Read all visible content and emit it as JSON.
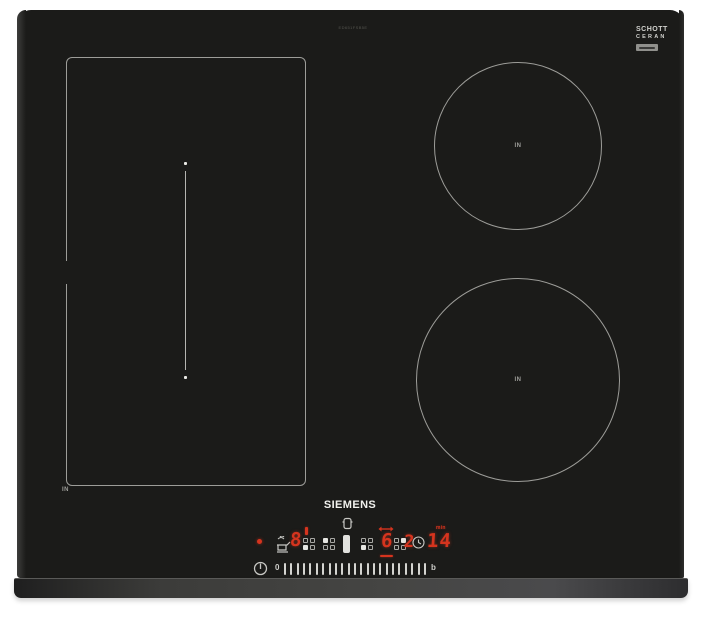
{
  "colors": {
    "glass": "#1b1b19",
    "zone_outline": "#9d9d99",
    "led_red": "#d6341e",
    "icon_white": "#cfcfcb",
    "trim_gray": "#454543"
  },
  "hob": {
    "model_code": "ED651FSB5E",
    "brand_logo": "SIEMENS",
    "glass_logo": {
      "line1": "SCHOTT",
      "line2": "CERAN"
    },
    "zones": {
      "flex_label": "IN",
      "top_right_label": "IN",
      "bottom_right_label": "IN"
    },
    "control_panel": {
      "left_display": "8",
      "center_display": "6",
      "right_display": "2",
      "timer_display": "14",
      "timer_unit": "min",
      "slider_start": "0",
      "slider_end": "b",
      "slider_tick_count": 23,
      "zone_keys": [
        {
          "filled": "bl"
        },
        {
          "filled": "tl"
        },
        {
          "filled": "bl"
        },
        {
          "filled": "tr"
        }
      ],
      "icons": {
        "power": "power-standby-icon",
        "clock": "timer-clock-icon",
        "fry": "frying-sensor-icon",
        "pot": "pot-detect-icon",
        "pan_bar": "pan-position-bar",
        "status": "residual-heat-dot"
      }
    }
  }
}
